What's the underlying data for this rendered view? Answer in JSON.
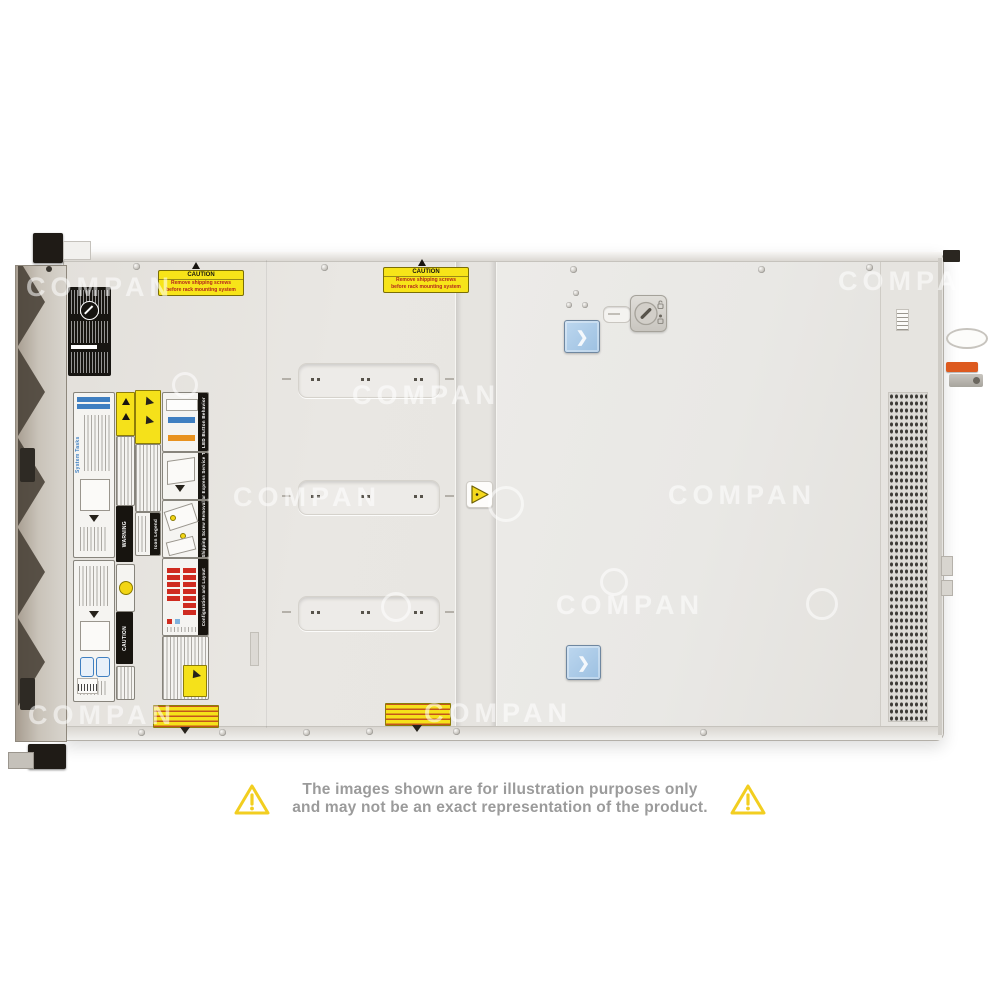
{
  "watermark": {
    "text": "COMPAN"
  },
  "disclaimer": {
    "line1": "The images shown are for illustration purposes only",
    "line2": "and may not be an exact representation of the product."
  },
  "caution": {
    "title": "CAUTION",
    "line1": "Remove shipping screws",
    "line2": "before rack mounting system"
  },
  "service": {
    "system_tasks": "System Tasks",
    "warning": "WARNING",
    "caution": "CAUTION",
    "icon_legend": "Icon Legend",
    "led_button_behavior": "LED Button Behavior",
    "rear_express_service_tag": "Rear Express Service Tag",
    "shipping_screw_removal": "Shipping Screw Removal",
    "configuration_and_layout": "Configuration and Layout"
  },
  "icons": {
    "chevron_right": "❯",
    "warning_triangle": "!",
    "keylock": "keyhole",
    "lock_states": "unlock/lock"
  },
  "colors": {
    "accent_blue": "#3f7fc1",
    "latch_blue": "#aecdea",
    "warning_yellow": "#f5e11a",
    "config_red": "#cf2b20",
    "led_orange": "#e8921f",
    "rear_clip_orange": "#dd5a1f",
    "disclaimer_text": "#9b9b9b",
    "disclaimer_triangle": "#f2ce20"
  }
}
